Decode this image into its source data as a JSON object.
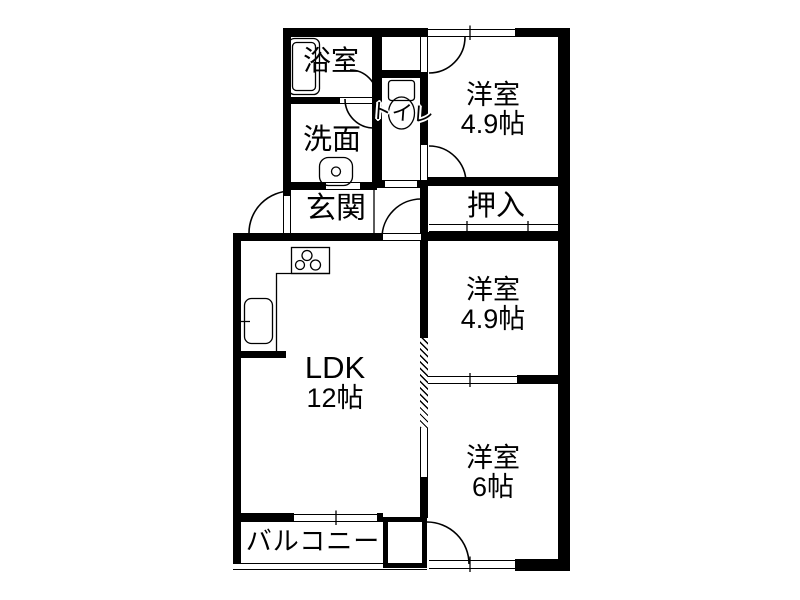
{
  "rooms": {
    "bathroom": {
      "name": "浴室"
    },
    "washroom": {
      "name": "洗面"
    },
    "toilet": {
      "name": "トイレ"
    },
    "entrance": {
      "name": "玄関"
    },
    "western_room_1": {
      "name": "洋室",
      "size": "4.9帖"
    },
    "closet": {
      "name": "押入"
    },
    "western_room_2": {
      "name": "洋室",
      "size": "4.9帖"
    },
    "western_room_3": {
      "name": "洋室",
      "size": "6帖"
    },
    "ldk": {
      "name": "LDK",
      "size": "12帖"
    },
    "balcony": {
      "name": "バルコニー"
    }
  },
  "colors": {
    "wall": "#000000",
    "background": "#ffffff",
    "line": "#000000"
  }
}
